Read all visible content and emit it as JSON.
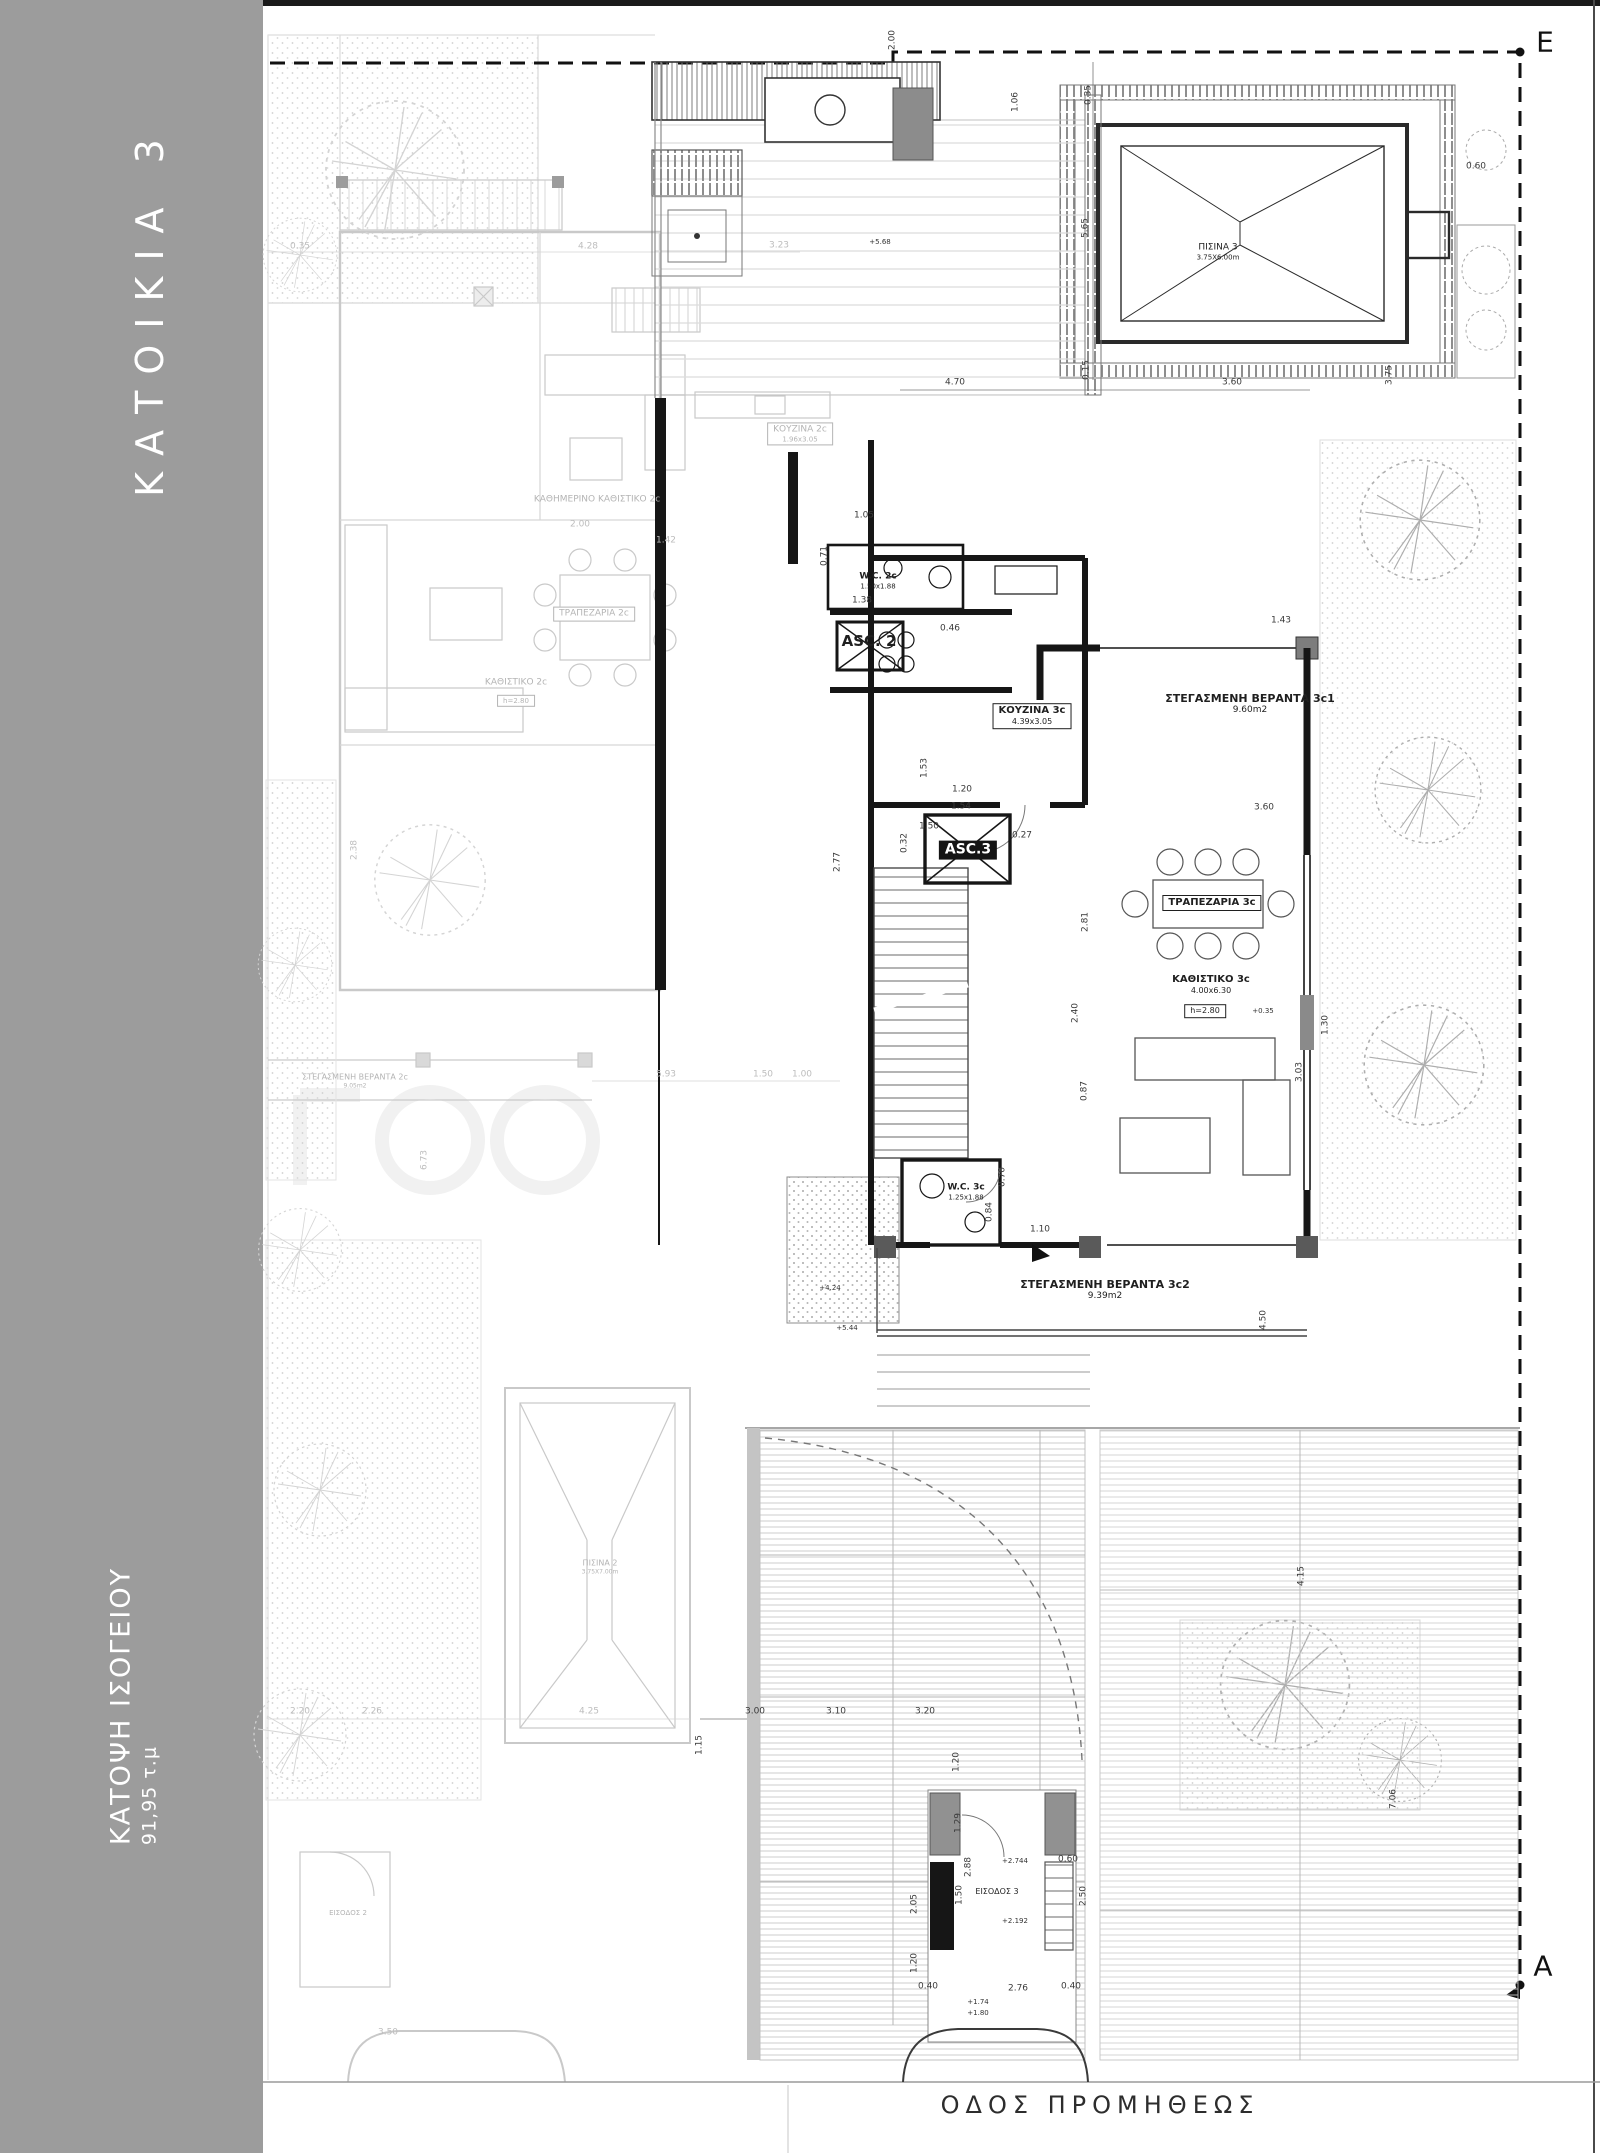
{
  "sidebar": {
    "title": "ΚΑΤΟΙΚΙΑ 3",
    "subtitle": "ΚΑΤΟΨΗ ΙΣΟΓΕΙΟΥ",
    "area_label": "91,95 τ.μ"
  },
  "street": {
    "name": "ΟΔΟΣ ΠΡΟΜΗΘΕΩΣ"
  },
  "section_markers": {
    "top_right": "E",
    "bottom_right": "A"
  },
  "colors": {
    "sidebar": "#9c9c9c",
    "ink": "#1f1f1f",
    "faded": "#b9b9b9",
    "wall": "#141414"
  },
  "plan": {
    "labels": [
      {
        "id": "room-kitchen-3c",
        "text": "ΚΟΥΖΙΝΑ 3c",
        "sub": "4.39x3.05",
        "x": 1032,
        "y": 716,
        "size": 10,
        "cls": "b box"
      },
      {
        "id": "room-veranda-3c1",
        "text": "ΣΤΕΓΑΣΜΕΝΗ ΒΕΡΑΝΤΑ 3c1",
        "sub": "9.60m2",
        "x": 1250,
        "y": 704,
        "size": 11,
        "cls": "b"
      },
      {
        "id": "room-dining-3c",
        "text": "ΤΡΑΠΕΖΑΡΙΑ 3c",
        "x": 1212,
        "y": 903,
        "size": 10,
        "cls": "b box"
      },
      {
        "id": "room-living-3c",
        "text": "ΚΑΘΙΣΤΙΚΟ 3c",
        "sub": "4.00x6.30",
        "x": 1211,
        "y": 985,
        "size": 10,
        "cls": "b"
      },
      {
        "id": "tag-living-3c-height",
        "text": "h=2.80",
        "x": 1205,
        "y": 1011,
        "size": 8,
        "cls": "box"
      },
      {
        "id": "level-living-3c",
        "text": "+0.35",
        "x": 1263,
        "y": 1011,
        "size": 7,
        "cls": "lvl"
      },
      {
        "id": "room-wc-3c",
        "text": "W.C. 3c",
        "sub": "1.25x1.88",
        "x": 966,
        "y": 1192,
        "size": 9,
        "cls": "b"
      },
      {
        "id": "room-asc-3",
        "text": "ASC.3",
        "x": 968,
        "y": 850,
        "size": 14,
        "cls": "b invbox"
      },
      {
        "id": "room-asc-2",
        "text": "ASC. 2",
        "x": 869,
        "y": 641,
        "size": 15,
        "cls": "b"
      },
      {
        "id": "room-wc-2c",
        "text": "W.C. 2c",
        "sub": "1.50x1.88",
        "x": 878,
        "y": 581,
        "size": 9,
        "cls": "b"
      },
      {
        "id": "room-veranda-3c2",
        "text": "ΣΤΕΓΑΣΜΕΝΗ ΒΕΡΑΝΤΑ 3c2",
        "sub": "9.39m2",
        "x": 1105,
        "y": 1290,
        "size": 11,
        "cls": "b"
      },
      {
        "id": "pool-3-label",
        "text": "ΠΙΣΙΝΑ 3",
        "sub": "3.75X6.00m",
        "x": 1218,
        "y": 252,
        "size": 9
      },
      {
        "id": "entrance-3-label",
        "text": "ΕΙΣΟΔΟΣ 3",
        "x": 997,
        "y": 1892,
        "size": 8
      },
      {
        "id": "room-daily-living-2c",
        "text": "ΚΑΘΗΜΕΡΙΝΟ ΚΑΘΙΣΤΙΚΟ 2c",
        "x": 597,
        "y": 500,
        "size": 9,
        "cls": "faded"
      },
      {
        "id": "room-dining-2c",
        "text": "ΤΡΑΠΕΖΑΡΙΑ 2c",
        "x": 594,
        "y": 614,
        "size": 9,
        "cls": "faded box"
      },
      {
        "id": "room-kitchen-2c",
        "text": "ΚΟΥΖΙΝΑ 2c",
        "sub": "1.96x3.05",
        "x": 800,
        "y": 434,
        "size": 9,
        "cls": "faded box"
      },
      {
        "id": "room-living-2c",
        "text": "ΚΑΘΙΣΤΙΚΟ 2c",
        "x": 516,
        "y": 683,
        "size": 9,
        "cls": "faded"
      },
      {
        "id": "tag-living-2c-height",
        "text": "h=2.80",
        "x": 516,
        "y": 701,
        "size": 7,
        "cls": "faded box"
      },
      {
        "id": "room-veranda-2c",
        "text": "ΣΤΕΓΑΣΜΕΝΗ ΒΕΡΑΝΤΑ 2c",
        "sub": "9.05m2",
        "x": 355,
        "y": 1081,
        "size": 8,
        "cls": "faded"
      },
      {
        "id": "pool-2-label",
        "text": "ΠΙΣΙΝΑ 2",
        "sub": "3.75X7.00m",
        "x": 600,
        "y": 1567,
        "size": 8,
        "cls": "faded"
      },
      {
        "id": "entrance-2-label",
        "text": "ΕΙΣΟΔΟΣ 2",
        "x": 348,
        "y": 1913,
        "size": 7,
        "cls": "faded"
      },
      {
        "id": "dim",
        "text": "0.35",
        "x": 1089,
        "y": 95,
        "size": 9,
        "rot": 1,
        "cls": "dim"
      },
      {
        "id": "dim",
        "text": "5.65",
        "x": 1086,
        "y": 228,
        "size": 9,
        "rot": 1,
        "cls": "dim"
      },
      {
        "id": "dim",
        "text": "0.15",
        "x": 1087,
        "y": 370,
        "size": 9,
        "rot": 1,
        "cls": "dim"
      },
      {
        "id": "dim",
        "text": "1.06",
        "x": 1016,
        "y": 102,
        "size": 9,
        "rot": 1,
        "cls": "dim"
      },
      {
        "id": "dim",
        "text": "0.60",
        "x": 1476,
        "y": 167,
        "size": 9,
        "cls": "dim"
      },
      {
        "id": "dim",
        "text": "4.70",
        "x": 955,
        "y": 383,
        "size": 9,
        "cls": "dim"
      },
      {
        "id": "dim",
        "text": "3.60",
        "x": 1232,
        "y": 383,
        "size": 9,
        "cls": "dim"
      },
      {
        "id": "dim",
        "text": "3.75",
        "x": 1390,
        "y": 375,
        "size": 9,
        "rot": 1,
        "cls": "dim"
      },
      {
        "id": "dim",
        "text": "2.00",
        "x": 893,
        "y": 40,
        "size": 9,
        "rot": 1,
        "cls": "dim"
      },
      {
        "id": "dim",
        "text": "1.43",
        "x": 1281,
        "y": 621,
        "size": 9,
        "cls": "dim"
      },
      {
        "id": "dim",
        "text": "0.46",
        "x": 950,
        "y": 629,
        "size": 9,
        "cls": "dim"
      },
      {
        "id": "dim",
        "text": "1.05",
        "x": 864,
        "y": 516,
        "size": 9,
        "cls": "dim"
      },
      {
        "id": "dim",
        "text": "0.71",
        "x": 825,
        "y": 556,
        "size": 9,
        "rot": 1,
        "cls": "dim"
      },
      {
        "id": "dim",
        "text": "1.38",
        "x": 862,
        "y": 601,
        "size": 9,
        "cls": "dim"
      },
      {
        "id": "dim",
        "text": "1.54",
        "x": 961,
        "y": 807,
        "size": 9,
        "cls": "dim"
      },
      {
        "id": "dim",
        "text": "1.50",
        "x": 929,
        "y": 827,
        "size": 9,
        "cls": "dim"
      },
      {
        "id": "dim",
        "text": "0.27",
        "x": 1022,
        "y": 836,
        "size": 9,
        "cls": "dim"
      },
      {
        "id": "dim",
        "text": "3.60",
        "x": 1264,
        "y": 808,
        "size": 9,
        "cls": "dim"
      },
      {
        "id": "dim",
        "text": "1.53",
        "x": 925,
        "y": 768,
        "size": 9,
        "rot": 1,
        "cls": "dim"
      },
      {
        "id": "dim",
        "text": "1.20",
        "x": 962,
        "y": 790,
        "size": 9,
        "cls": "dim"
      },
      {
        "id": "dim",
        "text": "0.32",
        "x": 905,
        "y": 843,
        "size": 9,
        "rot": 1,
        "cls": "dim"
      },
      {
        "id": "dim",
        "text": "2.77",
        "x": 838,
        "y": 862,
        "size": 9,
        "rot": 1,
        "cls": "dim"
      },
      {
        "id": "dim",
        "text": "2.81",
        "x": 1086,
        "y": 922,
        "size": 9,
        "rot": 1,
        "cls": "dim"
      },
      {
        "id": "dim",
        "text": "2.40",
        "x": 1076,
        "y": 1013,
        "size": 9,
        "rot": 1,
        "cls": "dim"
      },
      {
        "id": "dim",
        "text": "1.30",
        "x": 1326,
        "y": 1025,
        "size": 9,
        "rot": 1,
        "cls": "dim"
      },
      {
        "id": "dim",
        "text": "3.03",
        "x": 1300,
        "y": 1072,
        "size": 9,
        "rot": 1,
        "cls": "dim"
      },
      {
        "id": "dim",
        "text": "0.87",
        "x": 1085,
        "y": 1091,
        "size": 9,
        "rot": 1,
        "cls": "dim"
      },
      {
        "id": "dim",
        "text": "0.70",
        "x": 1003,
        "y": 1177,
        "size": 9,
        "rot": 1,
        "cls": "dim"
      },
      {
        "id": "dim",
        "text": "0.84",
        "x": 990,
        "y": 1212,
        "size": 9,
        "rot": 1,
        "cls": "dim"
      },
      {
        "id": "dim",
        "text": "1.10",
        "x": 1040,
        "y": 1230,
        "size": 9,
        "cls": "dim"
      },
      {
        "id": "dim",
        "text": "4.50",
        "x": 1264,
        "y": 1320,
        "size": 9,
        "rot": 1,
        "cls": "dim"
      },
      {
        "id": "dim",
        "text": "4.15",
        "x": 1302,
        "y": 1576,
        "size": 9,
        "rot": 1,
        "cls": "dim"
      },
      {
        "id": "dim",
        "text": "7.06",
        "x": 1394,
        "y": 1799,
        "size": 9,
        "rot": 1,
        "cls": "dim"
      },
      {
        "id": "dim",
        "text": "3.00",
        "x": 755,
        "y": 1712,
        "size": 9,
        "cls": "dim"
      },
      {
        "id": "dim",
        "text": "3.10",
        "x": 836,
        "y": 1712,
        "size": 9,
        "cls": "dim"
      },
      {
        "id": "dim",
        "text": "3.20",
        "x": 925,
        "y": 1712,
        "size": 9,
        "cls": "dim"
      },
      {
        "id": "dim",
        "text": "1.15",
        "x": 700,
        "y": 1745,
        "size": 9,
        "rot": 1,
        "cls": "dim"
      },
      {
        "id": "dim",
        "text": "2.05",
        "x": 915,
        "y": 1904,
        "size": 9,
        "rot": 1,
        "cls": "dim"
      },
      {
        "id": "dim",
        "text": "1.20",
        "x": 957,
        "y": 1762,
        "size": 9,
        "rot": 1,
        "cls": "dim"
      },
      {
        "id": "dim",
        "text": "1.29",
        "x": 959,
        "y": 1823,
        "size": 9,
        "rot": 1,
        "cls": "dim"
      },
      {
        "id": "dim",
        "text": "2.88",
        "x": 969,
        "y": 1867,
        "size": 9,
        "rot": 1,
        "cls": "dim"
      },
      {
        "id": "dim",
        "text": "1.50",
        "x": 960,
        "y": 1895,
        "size": 9,
        "rot": 1,
        "cls": "dim"
      },
      {
        "id": "dim",
        "text": "1.20",
        "x": 915,
        "y": 1963,
        "size": 9,
        "rot": 1,
        "cls": "dim"
      },
      {
        "id": "dim",
        "text": "0.40",
        "x": 928,
        "y": 1987,
        "size": 9,
        "cls": "dim"
      },
      {
        "id": "dim",
        "text": "2.76",
        "x": 1018,
        "y": 1989,
        "size": 9,
        "cls": "dim"
      },
      {
        "id": "dim",
        "text": "0.40",
        "x": 1071,
        "y": 1987,
        "size": 9,
        "cls": "dim"
      },
      {
        "id": "dim",
        "text": "0.60",
        "x": 1068,
        "y": 1860,
        "size": 9,
        "cls": "dim"
      },
      {
        "id": "dim",
        "text": "2.50",
        "x": 1084,
        "y": 1896,
        "size": 9,
        "rot": 1,
        "cls": "dim"
      },
      {
        "id": "level",
        "text": "+5.68",
        "x": 880,
        "y": 242,
        "size": 7,
        "cls": "lvl"
      },
      {
        "id": "level",
        "text": "+2.744",
        "x": 1015,
        "y": 1861,
        "size": 7,
        "cls": "lvl"
      },
      {
        "id": "level",
        "text": "+2.192",
        "x": 1015,
        "y": 1921,
        "size": 7,
        "cls": "lvl"
      },
      {
        "id": "level",
        "text": "+1.74",
        "x": 978,
        "y": 2002,
        "size": 7,
        "cls": "lvl"
      },
      {
        "id": "level",
        "text": "+1.80",
        "x": 978,
        "y": 2013,
        "size": 7,
        "cls": "lvl"
      },
      {
        "id": "level",
        "text": "+5.44",
        "x": 847,
        "y": 1328,
        "size": 7,
        "cls": "lvl"
      },
      {
        "id": "level",
        "text": "+4.24",
        "x": 830,
        "y": 1288,
        "size": 7,
        "cls": "lvl"
      },
      {
        "id": "dim-faded",
        "text": "0.35",
        "x": 300,
        "y": 247,
        "size": 9,
        "cls": "dimf"
      },
      {
        "id": "dim-faded",
        "text": "4.28",
        "x": 588,
        "y": 247,
        "size": 9,
        "cls": "dimf"
      },
      {
        "id": "dim-faded",
        "text": "3.23",
        "x": 779,
        "y": 246,
        "size": 9,
        "cls": "dimf"
      },
      {
        "id": "dim-faded",
        "text": "2.00",
        "x": 580,
        "y": 525,
        "size": 9,
        "cls": "dimf"
      },
      {
        "id": "dim-faded",
        "text": "1.42",
        "x": 666,
        "y": 541,
        "size": 9,
        "cls": "dimf"
      },
      {
        "id": "dim-faded",
        "text": "5.93",
        "x": 666,
        "y": 1075,
        "size": 9,
        "cls": "dimf"
      },
      {
        "id": "dim-faded",
        "text": "1.50",
        "x": 763,
        "y": 1075,
        "size": 9,
        "cls": "dimf"
      },
      {
        "id": "dim-faded",
        "text": "1.00",
        "x": 802,
        "y": 1075,
        "size": 9,
        "cls": "dimf"
      },
      {
        "id": "dim-faded",
        "text": "6.73",
        "x": 425,
        "y": 1160,
        "size": 9,
        "rot": 1,
        "cls": "dimf"
      },
      {
        "id": "dim-faded",
        "text": "2.38",
        "x": 355,
        "y": 850,
        "size": 9,
        "rot": 1,
        "cls": "dimf"
      },
      {
        "id": "dim-faded",
        "text": "2.20",
        "x": 300,
        "y": 1712,
        "size": 9,
        "cls": "dimf"
      },
      {
        "id": "dim-faded",
        "text": "2.26",
        "x": 372,
        "y": 1712,
        "size": 9,
        "cls": "dimf"
      },
      {
        "id": "dim-faded",
        "text": "4.25",
        "x": 589,
        "y": 1712,
        "size": 9,
        "cls": "dimf"
      },
      {
        "id": "dim-faded",
        "text": "3.50",
        "x": 388,
        "y": 2033,
        "size": 9,
        "cls": "dimf"
      }
    ]
  }
}
